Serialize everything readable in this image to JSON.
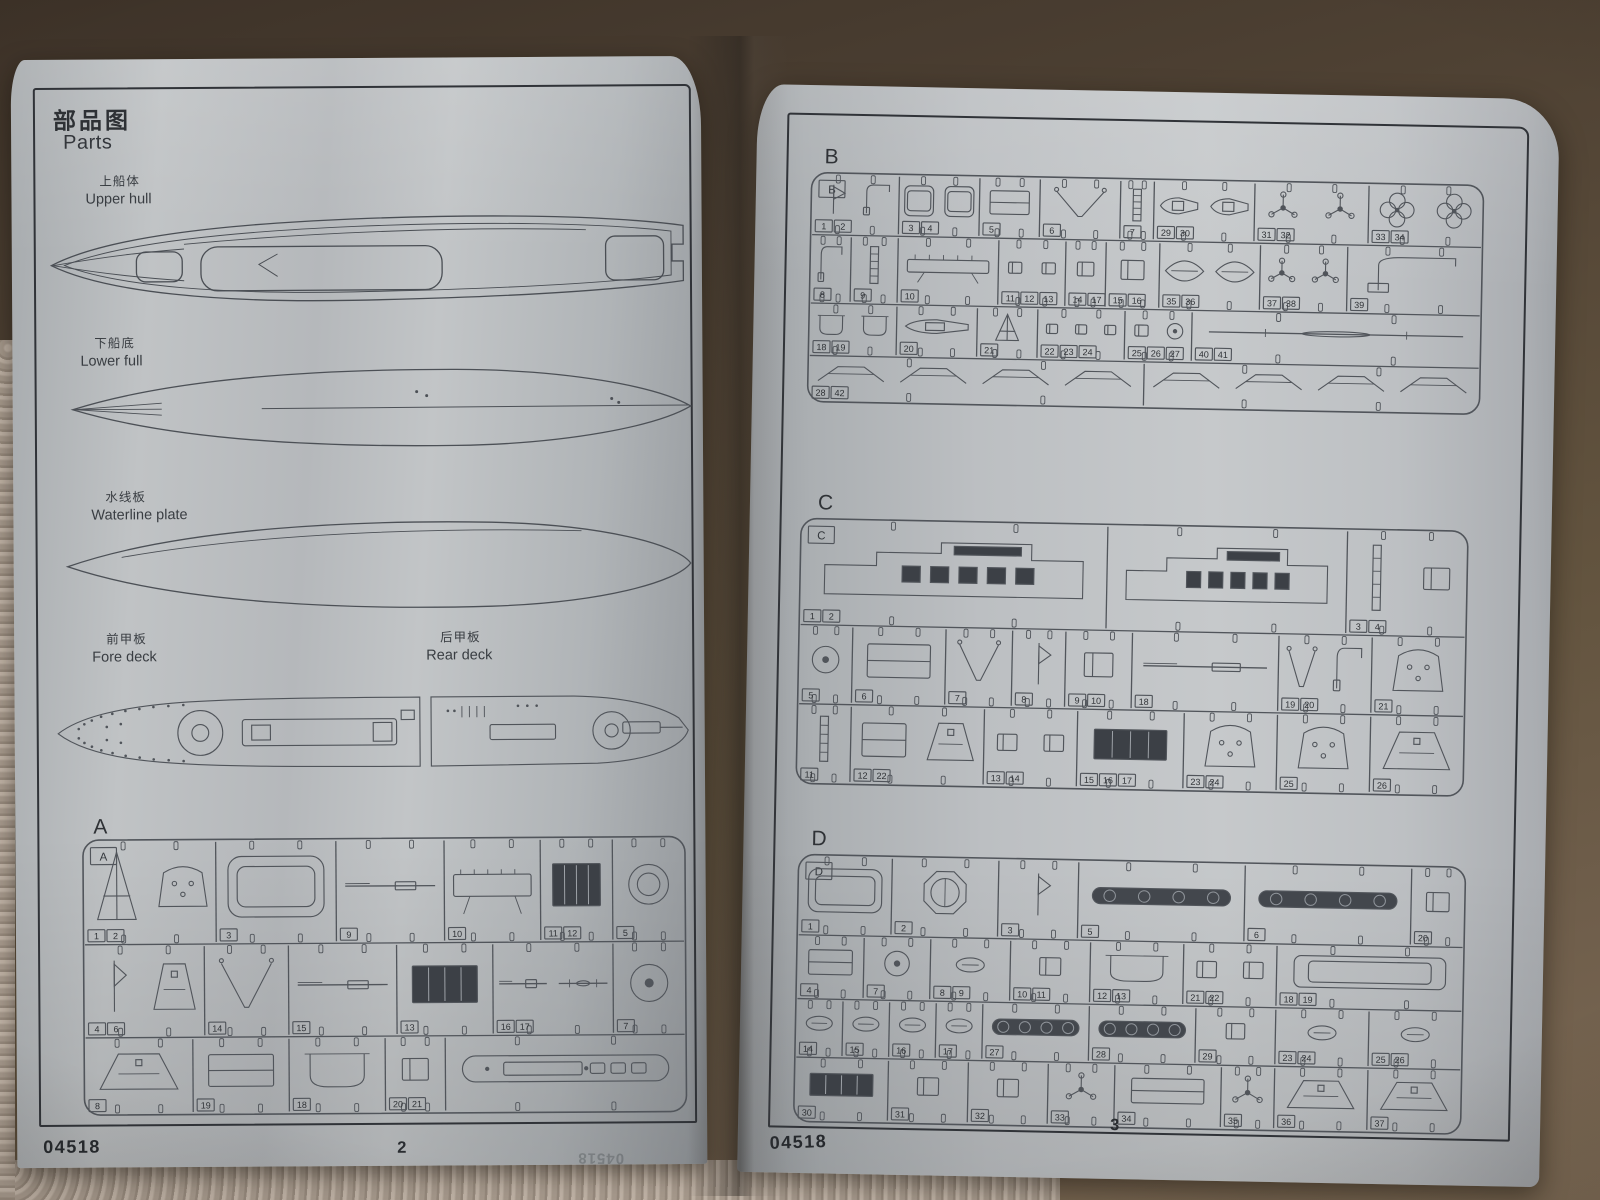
{
  "booklet": {
    "kit_number": "04518"
  },
  "pages": {
    "left": {
      "header": {
        "title_cn": "部品图",
        "title_en": "Parts"
      },
      "figures": {
        "upper_hull": {
          "cn": "上船体",
          "en": "Upper hull"
        },
        "lower_hull": {
          "cn": "下船底",
          "en": "Lower full"
        },
        "waterline_plate": {
          "cn": "水线板",
          "en": "Waterline plate"
        },
        "fore_deck": {
          "cn": "前甲板",
          "en": "Fore deck"
        },
        "rear_deck": {
          "cn": "后甲板",
          "en": "Rear deck"
        }
      },
      "footer": {
        "kit_number": "04518",
        "page_number": "2",
        "show_through": "04518"
      }
    },
    "right": {
      "footer": {
        "kit_number": "04518",
        "page_number": "3"
      }
    }
  },
  "sprues": [
    {
      "letter": "A",
      "rows": [
        {
          "h": 0.38,
          "cells": [
            {
              "w": 0.22,
              "n": [
                "1",
                "2"
              ],
              "g": [
                "cone",
                "turret"
              ]
            },
            {
              "w": 0.2,
              "n": [
                "3"
              ],
              "g": [
                "plate"
              ]
            },
            {
              "w": 0.18,
              "n": [
                "9"
              ],
              "g": [
                "gun"
              ]
            },
            {
              "w": 0.16,
              "n": [
                "10"
              ],
              "g": [
                "platform"
              ]
            },
            {
              "w": 0.12,
              "n": [
                "11",
                "12"
              ],
              "g": [
                "grid"
              ]
            },
            {
              "w": 0.12,
              "n": [
                "5"
              ],
              "g": [
                "ring"
              ]
            }
          ]
        },
        {
          "h": 0.34,
          "cells": [
            {
              "w": 0.2,
              "n": [
                "4",
                "6"
              ],
              "g": [
                "wedge",
                "trap"
              ]
            },
            {
              "w": 0.14,
              "n": [
                "14"
              ],
              "g": [
                "davit"
              ]
            },
            {
              "w": 0.18,
              "n": [
                "15"
              ],
              "g": [
                "gun"
              ]
            },
            {
              "w": 0.16,
              "n": [
                "13"
              ],
              "g": [
                "grid"
              ]
            },
            {
              "w": 0.2,
              "n": [
                "16",
                "17"
              ],
              "g": [
                "gun",
                "mast"
              ]
            },
            {
              "w": 0.12,
              "n": [
                "7"
              ],
              "g": [
                "disc"
              ]
            }
          ]
        },
        {
          "h": 0.28,
          "cells": [
            {
              "w": 0.18,
              "n": [
                "8"
              ],
              "g": [
                "trap"
              ]
            },
            {
              "w": 0.16,
              "n": [
                "19"
              ],
              "g": [
                "box"
              ]
            },
            {
              "w": 0.16,
              "n": [
                "18"
              ],
              "g": [
                "tub"
              ]
            },
            {
              "w": 0.1,
              "n": [
                "20",
                "21"
              ],
              "g": [
                "sbox"
              ]
            },
            {
              "w": 0.4,
              "n": [],
              "g": [
                "deckb"
              ]
            }
          ]
        }
      ]
    },
    {
      "letter": "B",
      "rows": [
        {
          "h": 0.27,
          "cells": [
            {
              "w": 0.13,
              "n": [
                "1",
                "2"
              ],
              "g": [
                "wedge",
                "crane"
              ]
            },
            {
              "w": 0.12,
              "n": [
                "3",
                "4"
              ],
              "g": [
                "plate",
                "plate"
              ]
            },
            {
              "w": 0.09,
              "n": [
                "5"
              ],
              "g": [
                "box"
              ]
            },
            {
              "w": 0.12,
              "n": [
                "6"
              ],
              "g": [
                "davit"
              ]
            },
            {
              "w": 0.05,
              "n": [
                "7"
              ],
              "g": [
                "ladder"
              ]
            },
            {
              "w": 0.15,
              "n": [
                "29",
                "30"
              ],
              "g": [
                "boat",
                "boat"
              ]
            },
            {
              "w": 0.17,
              "n": [
                "31",
                "32"
              ],
              "g": [
                "prop3",
                "prop3"
              ]
            },
            {
              "w": 0.17,
              "n": [
                "33",
                "34"
              ],
              "g": [
                "prop4",
                "prop4"
              ]
            }
          ]
        },
        {
          "h": 0.3,
          "cells": [
            {
              "w": 0.06,
              "n": [
                "8"
              ],
              "g": [
                "crane"
              ]
            },
            {
              "w": 0.07,
              "n": [
                "9"
              ],
              "g": [
                "ladder"
              ]
            },
            {
              "w": 0.15,
              "n": [
                "10"
              ],
              "g": [
                "platform"
              ]
            },
            {
              "w": 0.1,
              "n": [
                "11",
                "12",
                "13"
              ],
              "g": [
                "sbox",
                "sbox"
              ]
            },
            {
              "w": 0.06,
              "n": [
                "14",
                "17"
              ],
              "g": [
                "sbox"
              ]
            },
            {
              "w": 0.08,
              "n": [
                "15",
                "16"
              ],
              "g": [
                "sbox"
              ]
            },
            {
              "w": 0.15,
              "n": [
                "35",
                "36"
              ],
              "g": [
                "hull",
                "hull"
              ]
            },
            {
              "w": 0.13,
              "n": [
                "37",
                "38"
              ],
              "g": [
                "prop3",
                "prop3"
              ]
            },
            {
              "w": 0.2,
              "n": [
                "39"
              ],
              "g": [
                "crane"
              ]
            }
          ]
        },
        {
          "h": 0.23,
          "cells": [
            {
              "w": 0.13,
              "n": [
                "18",
                "19"
              ],
              "g": [
                "tub",
                "tub"
              ]
            },
            {
              "w": 0.12,
              "n": [
                "20"
              ],
              "g": [
                "boat"
              ]
            },
            {
              "w": 0.09,
              "n": [
                "21"
              ],
              "g": [
                "cone"
              ]
            },
            {
              "w": 0.13,
              "n": [
                "22",
                "23",
                "24"
              ],
              "g": [
                "sbox",
                "sbox",
                "sbox"
              ]
            },
            {
              "w": 0.1,
              "n": [
                "25",
                "26",
                "27"
              ],
              "g": [
                "sbox",
                "disc"
              ]
            },
            {
              "w": 0.43,
              "n": [
                "40",
                "41"
              ],
              "g": [
                "mast"
              ]
            }
          ]
        },
        {
          "h": 0.2,
          "cells": [
            {
              "w": 0.5,
              "n": [
                "28",
                "42"
              ],
              "g": [
                "brace"
              ]
            },
            {
              "w": 0.5,
              "n": [],
              "g": [
                "brace"
              ]
            }
          ]
        }
      ]
    },
    {
      "letter": "C",
      "rows": [
        {
          "h": 0.4,
          "cells": [
            {
              "w": 0.46,
              "n": [
                "1",
                "2"
              ],
              "g": [
                "block"
              ]
            },
            {
              "w": 0.36,
              "n": [],
              "g": [
                "block"
              ]
            },
            {
              "w": 0.18,
              "n": [
                "3",
                "4"
              ],
              "g": [
                "ladder",
                "sbox"
              ]
            }
          ]
        },
        {
          "h": 0.3,
          "cells": [
            {
              "w": 0.08,
              "n": [
                "5"
              ],
              "g": [
                "disc"
              ]
            },
            {
              "w": 0.14,
              "n": [
                "6"
              ],
              "g": [
                "box"
              ]
            },
            {
              "w": 0.1,
              "n": [
                "7"
              ],
              "g": [
                "davit"
              ]
            },
            {
              "w": 0.08,
              "n": [
                "8"
              ],
              "g": [
                "wedge"
              ]
            },
            {
              "w": 0.1,
              "n": [
                "9",
                "10"
              ],
              "g": [
                "sbox"
              ]
            },
            {
              "w": 0.22,
              "n": [
                "18"
              ],
              "g": [
                "gun"
              ]
            },
            {
              "w": 0.14,
              "n": [
                "19",
                "20"
              ],
              "g": [
                "davit",
                "crane"
              ]
            },
            {
              "w": 0.14,
              "n": [
                "21"
              ],
              "g": [
                "turret"
              ]
            }
          ]
        },
        {
          "h": 0.3,
          "cells": [
            {
              "w": 0.08,
              "n": [
                "11"
              ],
              "g": [
                "ladder"
              ]
            },
            {
              "w": 0.2,
              "n": [
                "12",
                "22"
              ],
              "g": [
                "box",
                "trap"
              ]
            },
            {
              "w": 0.14,
              "n": [
                "13",
                "14"
              ],
              "g": [
                "sbox",
                "sbox"
              ]
            },
            {
              "w": 0.16,
              "n": [
                "15",
                "16",
                "17"
              ],
              "g": [
                "grid"
              ]
            },
            {
              "w": 0.14,
              "n": [
                "23",
                "24"
              ],
              "g": [
                "turret"
              ]
            },
            {
              "w": 0.14,
              "n": [
                "25"
              ],
              "g": [
                "turret"
              ]
            },
            {
              "w": 0.14,
              "n": [
                "26"
              ],
              "g": [
                "trap"
              ]
            }
          ]
        }
      ]
    },
    {
      "letter": "D",
      "rows": [
        {
          "h": 0.3,
          "cells": [
            {
              "w": 0.14,
              "n": [
                "1"
              ],
              "g": [
                "plate"
              ]
            },
            {
              "w": 0.16,
              "n": [
                "2"
              ],
              "g": [
                "oct"
              ]
            },
            {
              "w": 0.12,
              "n": [
                "3"
              ],
              "g": [
                "wedge"
              ]
            },
            {
              "w": 0.25,
              "n": [
                "5"
              ],
              "g": [
                "strip"
              ]
            },
            {
              "w": 0.25,
              "n": [
                "6"
              ],
              "g": [
                "strip"
              ]
            },
            {
              "w": 0.08,
              "n": [
                "20"
              ],
              "g": [
                "sbox"
              ]
            }
          ]
        },
        {
          "h": 0.24,
          "cells": [
            {
              "w": 0.1,
              "n": [
                "4"
              ],
              "g": [
                "box"
              ]
            },
            {
              "w": 0.1,
              "n": [
                "7"
              ],
              "g": [
                "disc"
              ]
            },
            {
              "w": 0.12,
              "n": [
                "8",
                "9"
              ],
              "g": [
                "ovals"
              ]
            },
            {
              "w": 0.12,
              "n": [
                "10",
                "11"
              ],
              "g": [
                "sbox"
              ]
            },
            {
              "w": 0.14,
              "n": [
                "12",
                "13"
              ],
              "g": [
                "tub"
              ]
            },
            {
              "w": 0.14,
              "n": [
                "21",
                "22"
              ],
              "g": [
                "sbox",
                "sbox"
              ]
            },
            {
              "w": 0.28,
              "n": [
                "18",
                "19"
              ],
              "g": [
                "plate"
              ]
            }
          ]
        },
        {
          "h": 0.22,
          "cells": [
            {
              "w": 0.07,
              "n": [
                "14"
              ],
              "g": [
                "ovals"
              ]
            },
            {
              "w": 0.07,
              "n": [
                "15"
              ],
              "g": [
                "ovals"
              ]
            },
            {
              "w": 0.07,
              "n": [
                "16"
              ],
              "g": [
                "ovals"
              ]
            },
            {
              "w": 0.07,
              "n": [
                "17"
              ],
              "g": [
                "ovals"
              ]
            },
            {
              "w": 0.16,
              "n": [
                "27"
              ],
              "g": [
                "strip"
              ]
            },
            {
              "w": 0.16,
              "n": [
                "28"
              ],
              "g": [
                "strip"
              ]
            },
            {
              "w": 0.12,
              "n": [
                "29"
              ],
              "g": [
                "sbox"
              ]
            },
            {
              "w": 0.14,
              "n": [
                "23",
                "24"
              ],
              "g": [
                "ovals"
              ]
            },
            {
              "w": 0.14,
              "n": [
                "25",
                "26"
              ],
              "g": [
                "ovals"
              ]
            }
          ]
        },
        {
          "h": 0.24,
          "cells": [
            {
              "w": 0.14,
              "n": [
                "30"
              ],
              "g": [
                "grid"
              ]
            },
            {
              "w": 0.12,
              "n": [
                "31"
              ],
              "g": [
                "sbox"
              ]
            },
            {
              "w": 0.12,
              "n": [
                "32"
              ],
              "g": [
                "sbox"
              ]
            },
            {
              "w": 0.1,
              "n": [
                "33"
              ],
              "g": [
                "prop3"
              ]
            },
            {
              "w": 0.16,
              "n": [
                "34"
              ],
              "g": [
                "box"
              ]
            },
            {
              "w": 0.08,
              "n": [
                "35"
              ],
              "g": [
                "prop3"
              ]
            },
            {
              "w": 0.14,
              "n": [
                "36"
              ],
              "g": [
                "trap"
              ]
            },
            {
              "w": 0.14,
              "n": [
                "37"
              ],
              "g": [
                "trap"
              ]
            }
          ]
        }
      ]
    }
  ]
}
